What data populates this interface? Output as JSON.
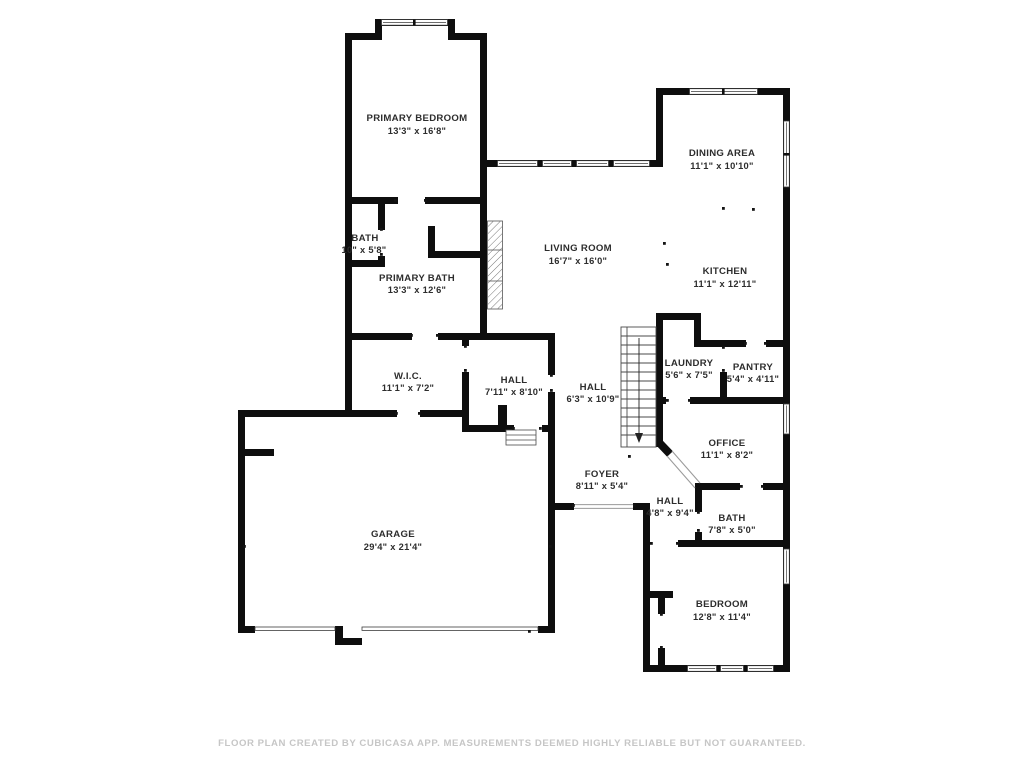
{
  "floor_plan": {
    "rooms": [
      {
        "name": "PRIMARY BEDROOM",
        "dims": "13'3\" x 16'8\""
      },
      {
        "name": "DINING AREA",
        "dims": "11'1\" x 10'10\""
      },
      {
        "name": "KITCHEN",
        "dims": "11'1\" x 12'11\""
      },
      {
        "name": "LIVING ROOM",
        "dims": "16'7\" x 16'0\""
      },
      {
        "name": "BATH",
        "dims": "10\" x 5'8\""
      },
      {
        "name": "PRIMARY BATH",
        "dims": "13'3\" x 12'6\""
      },
      {
        "name": "W.I.C.",
        "dims": "11'1\" x 7'2\""
      },
      {
        "name": "HALL",
        "dims": "7'11\" x 8'10\""
      },
      {
        "name": "HALL",
        "dims": "6'3\" x 10'9\""
      },
      {
        "name": "LAUNDRY",
        "dims": "5'6\" x 7'5\""
      },
      {
        "name": "PANTRY",
        "dims": "5'4\" x 4'11\""
      },
      {
        "name": "OFFICE",
        "dims": "11'1\" x 8'2\""
      },
      {
        "name": "FOYER",
        "dims": "8'11\" x 5'4\""
      },
      {
        "name": "HALL",
        "dims": "4'8\" x 9'4\""
      },
      {
        "name": "BATH",
        "dims": "7'8\" x 5'0\""
      },
      {
        "name": "GARAGE",
        "dims": "29'4\" x 21'4\""
      },
      {
        "name": "BEDROOM",
        "dims": "12'8\" x 11'4\""
      }
    ],
    "footer": "FLOOR PLAN CREATED BY CUBICASA APP. MEASUREMENTS DEEMED HIGHLY RELIABLE BUT NOT GUARANTEED.",
    "colors": {
      "wall": "#0e0e0e",
      "label": "#2d2d2d",
      "footer": "#c6c6c6",
      "background": "#ffffff"
    }
  }
}
